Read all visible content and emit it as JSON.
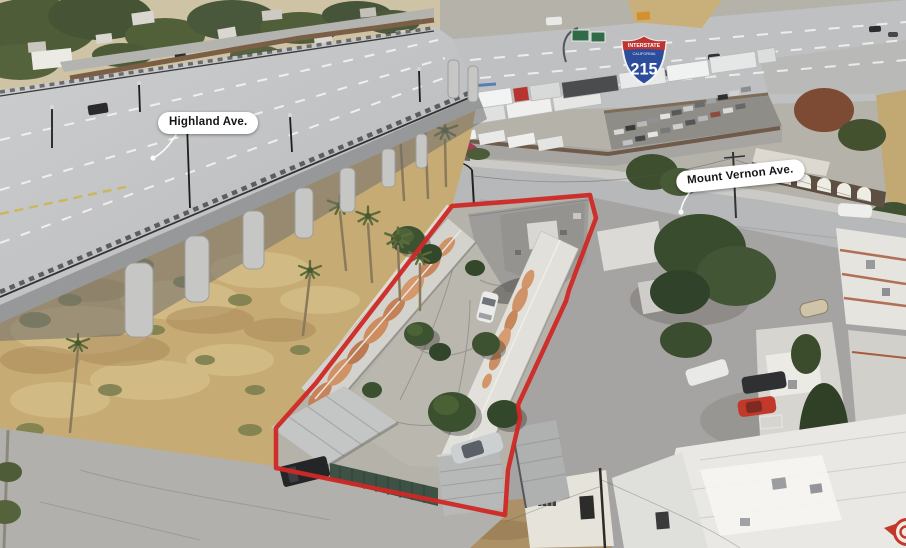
{
  "annotations": {
    "street_labels": [
      {
        "id": "highland",
        "text": "Highland Ave."
      },
      {
        "id": "mount-vernon",
        "text": "Mount Vernon Ave."
      }
    ],
    "highway_shield": {
      "band": "INTERSTATE",
      "state": "CALIFORNIA",
      "route": "215"
    },
    "property_outline": {
      "points": "452,206 518,201 590,195 596,218 569,290 566,301 518,405 520,418 508,470 505,515 276,468 276,428 316,383",
      "color": "#ce2a26",
      "stroke_width": "4.5"
    }
  },
  "colors": {
    "outline_red": "#ce2a26",
    "pill_bg": "#ffffff",
    "pill_text": "#151515",
    "shield_red": "#bf3430",
    "shield_blue": "#2c4d9c"
  }
}
